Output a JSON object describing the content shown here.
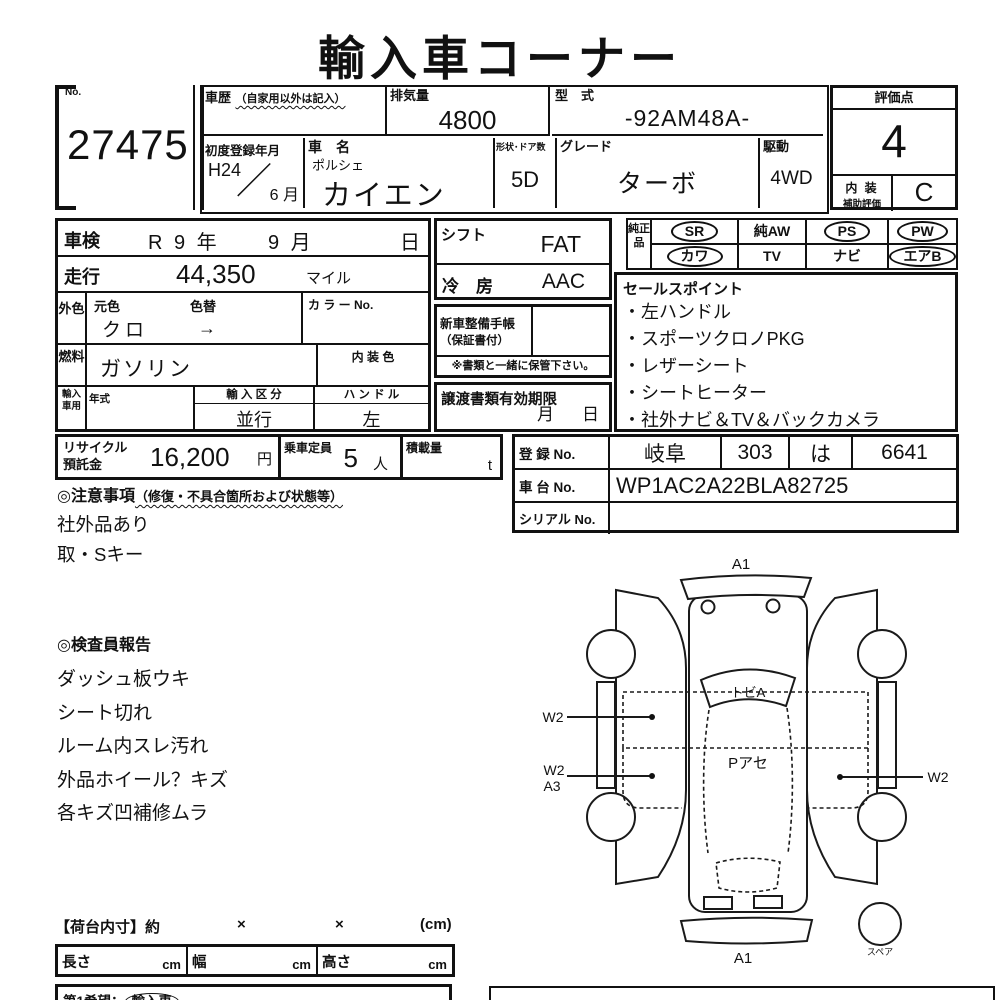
{
  "title": "輸入車コーナー",
  "no": {
    "label": "No.",
    "value": "27475"
  },
  "header": {
    "history": {
      "label": "車歴",
      "note": "（自家用以外は記入）"
    },
    "displacement": {
      "label": "排気量",
      "value": "4800"
    },
    "model_code": {
      "label": "型　式",
      "value": "-92AM48A-"
    },
    "first_reg": {
      "label": "初度登録年月",
      "year": "H24",
      "slash": "／",
      "month": "6 月"
    },
    "car_name": {
      "label": "車　名",
      "maker": "ポルシェ",
      "model": "カイエン"
    },
    "body_doors": {
      "label": "形状･ドア数",
      "value": "5D"
    },
    "grade": {
      "label": "グレード",
      "value": "ターボ"
    },
    "drive": {
      "label": "駆動",
      "value": "4WD"
    }
  },
  "score": {
    "label": "評価点",
    "value": "4",
    "interior_line1": "内 装",
    "interior_line2": "補助評価",
    "interior_value": "C"
  },
  "left_table": {
    "shaken": {
      "label": "車検",
      "year": "R 9 年",
      "month": "9 月",
      "day": "日"
    },
    "mileage": {
      "label": "走行",
      "value": "44,350",
      "unit": "マイル"
    },
    "ext_color": {
      "side_label": "外色",
      "orig_label": "元色",
      "orig_value": "クロ",
      "change_label": "色替",
      "arrow": "→",
      "color_no_label": "カ ラ ー No."
    },
    "fuel": {
      "side_label": "燃料",
      "value": "ガソリン",
      "interior_color_label": "内 装 色"
    },
    "import": {
      "side_label": "輸入車用",
      "year_label": "年式",
      "class_label": "輸 入 区 分",
      "class_value": "並行",
      "handle_label": "ハ ン ド ル",
      "handle_value": "左"
    }
  },
  "mid": {
    "shift": {
      "label": "シフト",
      "value": "FAT"
    },
    "ac": {
      "label": "冷　房",
      "value": "AAC"
    },
    "service": {
      "line1": "新車整備手帳",
      "line2": "（保証書付）",
      "keep_note": "※書類と一緒に保管下さい。"
    },
    "transfer": {
      "label": "譲渡書類有効期限",
      "month": "月",
      "day": "日"
    }
  },
  "genuine": {
    "label": "純正品",
    "items": [
      {
        "label": "SR",
        "circled": true
      },
      {
        "label": "純AW",
        "circled": false
      },
      {
        "label": "PS",
        "circled": true
      },
      {
        "label": "PW",
        "circled": true
      },
      {
        "label": "カワ",
        "circled": true
      },
      {
        "label": "TV",
        "circled": false
      },
      {
        "label": "ナビ",
        "circled": false
      },
      {
        "label": "エアB",
        "circled": true
      }
    ]
  },
  "sales": {
    "title": "セールスポイント",
    "items": [
      "左ハンドル",
      "スポーツクロノPKG",
      "レザーシート",
      "シートヒーター",
      "社外ナビ＆TV＆バックカメラ"
    ]
  },
  "recycle": {
    "line1": "リサイクル",
    "line2": "預託金",
    "value": "16,200",
    "unit": "円"
  },
  "capacity": {
    "label": "乗車定員",
    "value": "5",
    "unit": "人"
  },
  "load": {
    "label": "積載量",
    "unit": "t"
  },
  "registration": {
    "reg_label": "登 録 No.",
    "reg_area": "岐阜",
    "reg_class": "303",
    "reg_kana": "は",
    "reg_num": "6641",
    "chassis_label": "車 台 No.",
    "chassis_value": "WP1AC2A22BLA82725",
    "serial_label": "シリアル No."
  },
  "cautions": {
    "title": "◎注意事項",
    "note": "（修復・不具合箇所および状態等）",
    "items": [
      "社外品あり",
      "取・Sキー"
    ]
  },
  "inspector": {
    "title": "◎検査員報告",
    "items": [
      "ダッシュ板ウキ",
      "シート切れ",
      "ルーム内スレ汚れ",
      "外品ホイール？キズ",
      "各キズ凹補修ムラ"
    ]
  },
  "diagram": {
    "a1_top": "A1",
    "windshield": "トビA",
    "roof": "Pアセ",
    "w2_left": "W2",
    "w2_rear": "W2",
    "a3_rear": "A3",
    "w2_right": "W2",
    "a1_bottom": "A1",
    "spare": "スペア"
  },
  "cargo": {
    "title": "【荷台内寸】約",
    "x1": "×",
    "x2": "×",
    "unit": "(cm)",
    "length_label": "長さ",
    "length_unit": "cm",
    "width_label": "幅",
    "width_unit": "cm",
    "height_label": "高さ",
    "height_unit": "cm"
  },
  "bottom": {
    "wish_label": "第1希望：",
    "wish_value": "輸入車"
  }
}
